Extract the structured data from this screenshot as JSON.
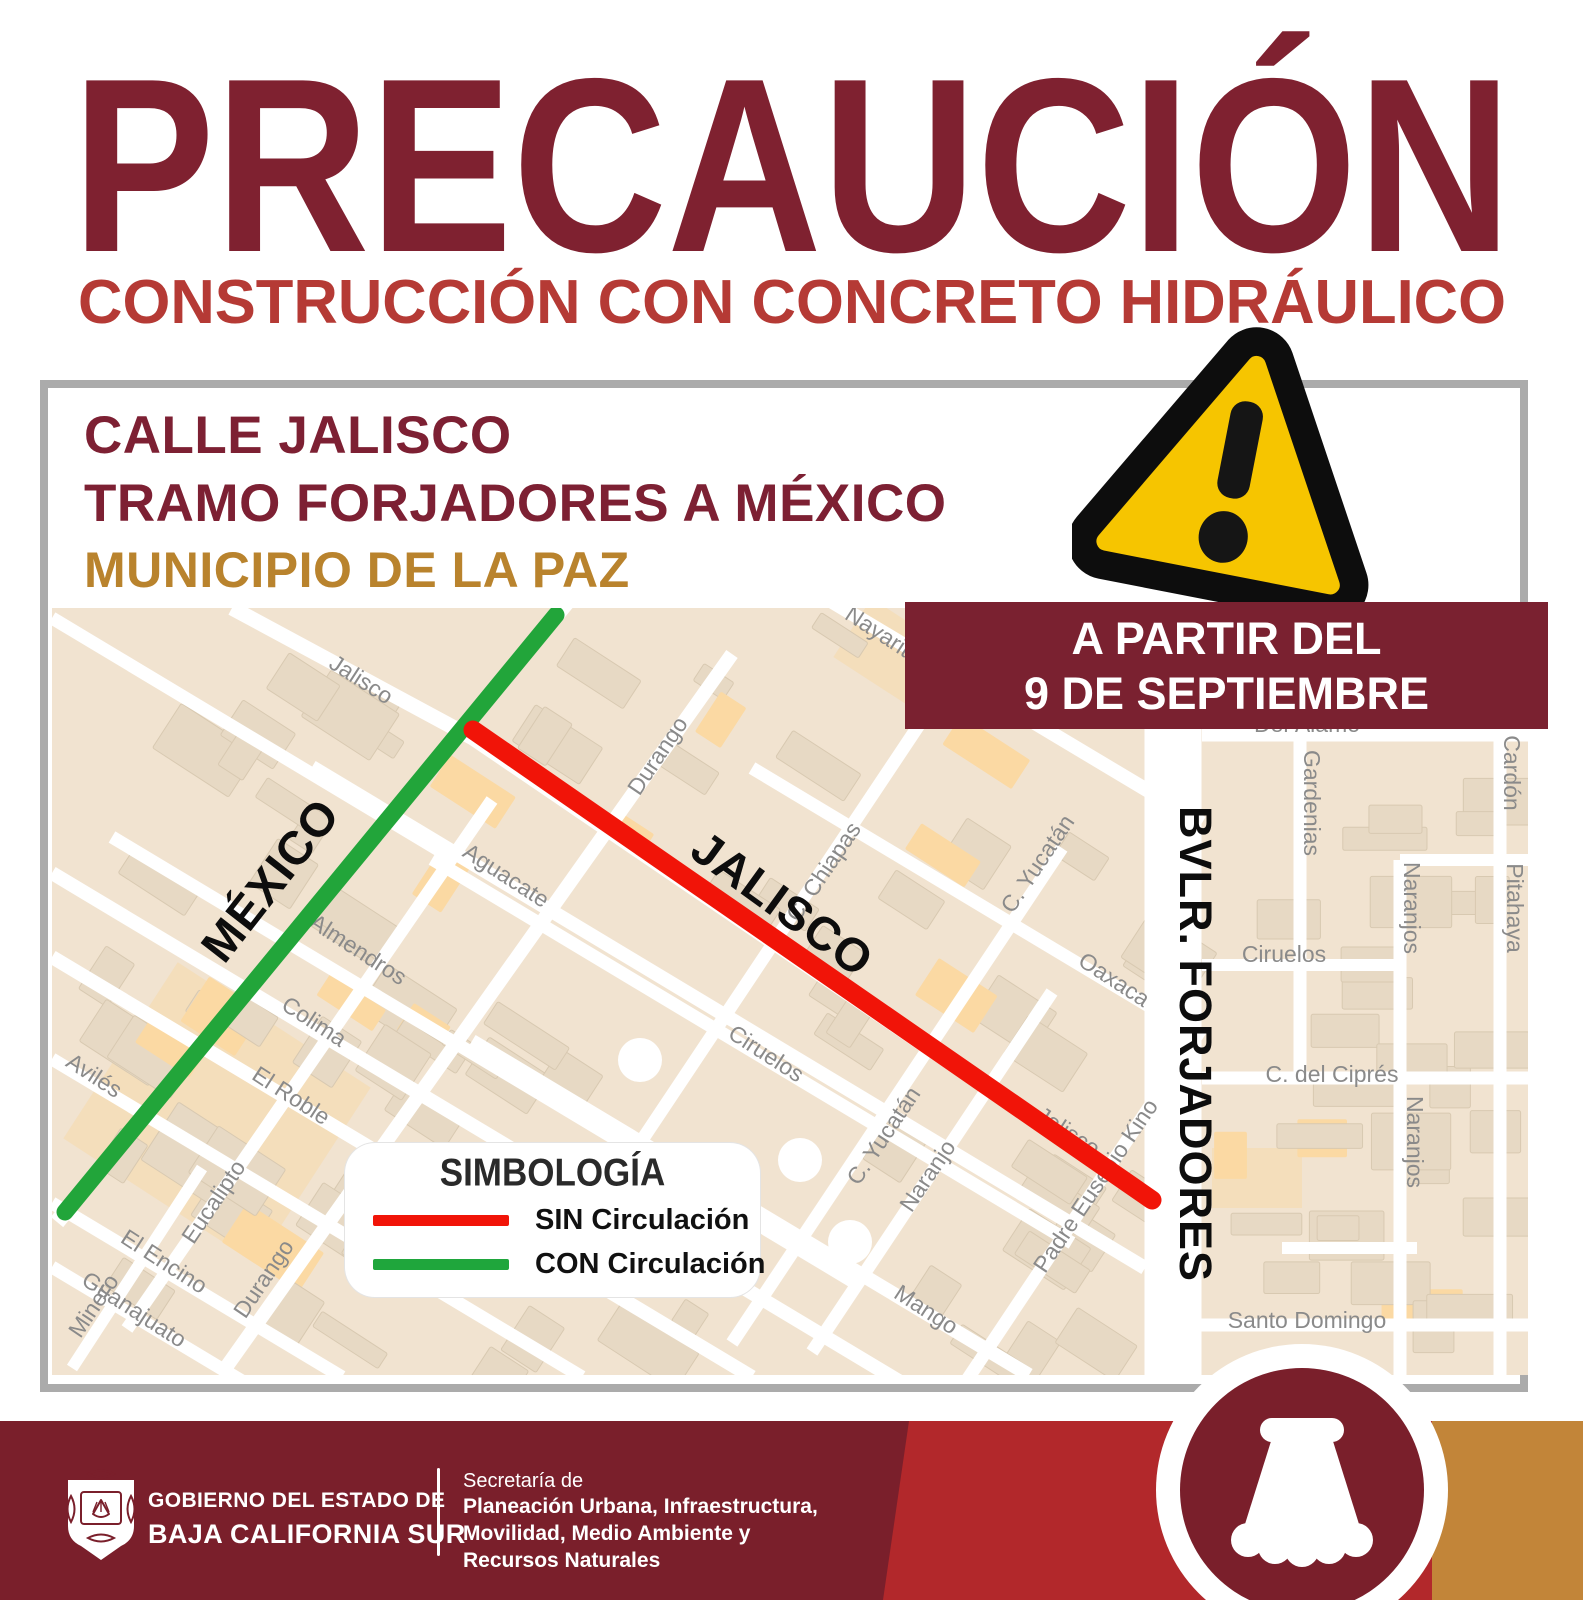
{
  "page": {
    "title_word": "PRECAUCIÓN",
    "subtitle": "CONSTRUCCIÓN CON CONCRETO HIDRÁULICO"
  },
  "notice": {
    "street": "CALLE JALISCO",
    "stretch": "TRAMO FORJADORES A MÉXICO",
    "municipality": "MUNICIPIO DE LA PAZ",
    "start_line1": "A PARTIR DEL",
    "start_line2": "9 DE SEPTIEMBRE"
  },
  "legend": {
    "title": "SIMBOLOGÍA",
    "items": [
      {
        "label": "SIN Circulación",
        "color": "#f11408"
      },
      {
        "label": "CON Circulación",
        "color": "#1fa63c"
      }
    ]
  },
  "map": {
    "open_route": {
      "name": "MÉXICO",
      "color": "#22a53a",
      "x1": 504,
      "y1": 7,
      "x2": 13,
      "y2": 604,
      "width": 17
    },
    "closed_route": {
      "name": "JALISCO",
      "color": "#f11408",
      "x1": 421,
      "y1": 122,
      "x2": 1100,
      "y2": 592,
      "width": 19
    },
    "big_labels": [
      {
        "text": "MÉXICO",
        "x": 231,
        "y": 282,
        "rot": -52,
        "size": 47
      },
      {
        "text": "JALISCO",
        "x": 721,
        "y": 309,
        "rot": 36,
        "size": 47
      },
      {
        "text": "BVLR. FORJADORES",
        "x": 1128,
        "y": 436,
        "rot": 90,
        "size": 45
      }
    ],
    "street_labels": [
      {
        "text": "Jalisco",
        "x": 305,
        "y": 78,
        "rot": 33
      },
      {
        "text": "Nayarit",
        "x": 822,
        "y": 30,
        "rot": 33
      },
      {
        "text": "Durango",
        "x": 612,
        "y": 152,
        "rot": -56
      },
      {
        "text": "Aguacate",
        "x": 450,
        "y": 274,
        "rot": 33
      },
      {
        "text": "Almendros",
        "x": 302,
        "y": 348,
        "rot": 33
      },
      {
        "text": "Colima",
        "x": 258,
        "y": 420,
        "rot": 33
      },
      {
        "text": "El Roble",
        "x": 235,
        "y": 494,
        "rot": 33
      },
      {
        "text": "Eucalipto",
        "x": 168,
        "y": 598,
        "rot": -56
      },
      {
        "text": "El Encino",
        "x": 108,
        "y": 660,
        "rot": 33
      },
      {
        "text": "Durango",
        "x": 218,
        "y": 675,
        "rot": -56
      },
      {
        "text": "Guanajuato",
        "x": 78,
        "y": 708,
        "rot": 33
      },
      {
        "text": "Avilés",
        "x": 38,
        "y": 474,
        "rot": 33
      },
      {
        "text": "Minero",
        "x": 48,
        "y": 702,
        "rot": -56
      },
      {
        "text": "C. Chiapas",
        "x": 778,
        "y": 268,
        "rot": -56
      },
      {
        "text": "C. Yucatán",
        "x": 992,
        "y": 260,
        "rot": -56
      },
      {
        "text": "Oaxaca",
        "x": 1058,
        "y": 378,
        "rot": 33
      },
      {
        "text": "C. Yucatán",
        "x": 838,
        "y": 532,
        "rot": -56
      },
      {
        "text": "Naranjo",
        "x": 882,
        "y": 572,
        "rot": -56
      },
      {
        "text": "Padre Eusebio Kino",
        "x": 1050,
        "y": 582,
        "rot": -56
      },
      {
        "text": "Jalisco",
        "x": 1012,
        "y": 530,
        "rot": 33
      },
      {
        "text": "Mango",
        "x": 870,
        "y": 708,
        "rot": 33
      },
      {
        "text": "Ciruelos",
        "x": 710,
        "y": 452,
        "rot": 33
      },
      {
        "text": "Del Álamo",
        "x": 1255,
        "y": 124,
        "rot": 0
      },
      {
        "text": "Gardenias",
        "x": 1252,
        "y": 195,
        "rot": 90
      },
      {
        "text": "Ciruelos",
        "x": 1232,
        "y": 354,
        "rot": 0
      },
      {
        "text": "Naranjos",
        "x": 1352,
        "y": 300,
        "rot": 90
      },
      {
        "text": "Naranjos",
        "x": 1355,
        "y": 534,
        "rot": 90
      },
      {
        "text": "C. del Ciprés",
        "x": 1280,
        "y": 474,
        "rot": 0
      },
      {
        "text": "Cardón",
        "x": 1452,
        "y": 165,
        "rot": 90
      },
      {
        "text": "Pitahaya",
        "x": 1455,
        "y": 300,
        "rot": 90
      },
      {
        "text": "Santo Domingo",
        "x": 1255,
        "y": 720,
        "rot": 0
      }
    ]
  },
  "footer": {
    "org_line1": "GOBIERNO DEL ESTADO DE",
    "org_line2": "BAJA CALIFORNIA SUR",
    "secretary_prefix": "Secretaría de",
    "secretary_lines": [
      "Planeación Urbana, Infraestructura,",
      "Movilidad, Medio Ambiente y",
      "Recursos Naturales"
    ]
  },
  "colors": {
    "title": "#7f2130",
    "subtitle": "#b53a35",
    "heading": "#7d2033",
    "gold": "#b9832d",
    "banner": "#7a2130",
    "footer_maroon": "#7a1f2b",
    "footer_red": "#b2282b",
    "footer_orange": "#c28539",
    "map_bg": "#f1e3d0",
    "warning_yellow": "#f6c500"
  }
}
